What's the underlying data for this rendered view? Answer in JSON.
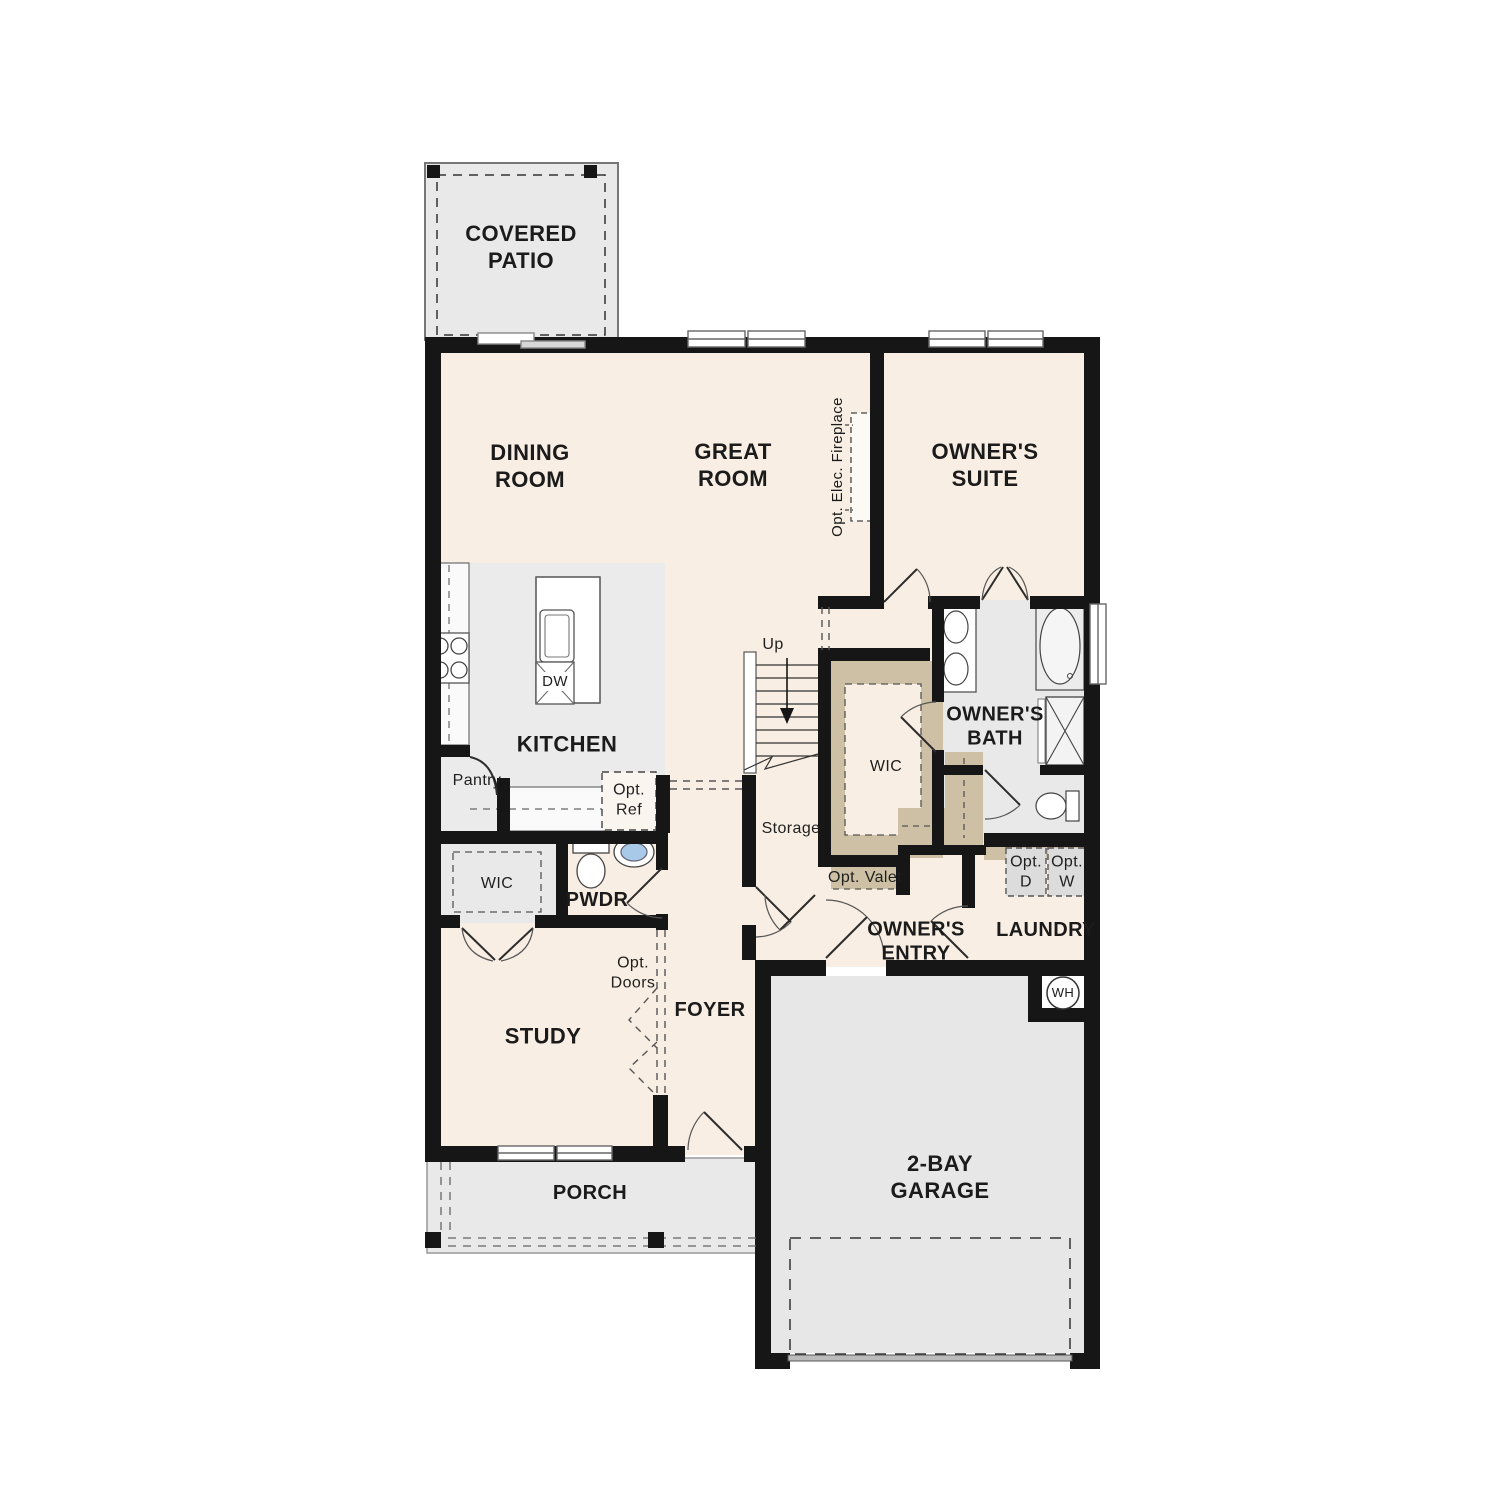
{
  "plan": {
    "rooms": {
      "covered_patio": "COVERED\nPATIO",
      "dining_room": "DINING\nROOM",
      "great_room": "GREAT\nROOM",
      "owners_suite": "OWNER'S\nSUITE",
      "kitchen": "KITCHEN",
      "study": "STUDY",
      "foyer": "FOYER",
      "porch": "PORCH",
      "garage": "2-BAY\nGARAGE",
      "owners_bath": "OWNER'S\nBATH",
      "laundry": "LAUNDRY",
      "owners_entry": "OWNER'S\nENTRY",
      "pwdr": "PWDR",
      "wic_primary": "WIC",
      "wic_secondary": "WIC",
      "storage": "Storage",
      "pantry": "Pantry"
    },
    "annotations": {
      "up": "Up",
      "dw": "DW",
      "opt_ref": "Opt.\nRef",
      "opt_valet": "Opt. Valet",
      "opt_d": "Opt.\nD",
      "opt_w": "Opt.\nW",
      "opt_doors": "Opt.\nDoors",
      "opt_elec_fireplace": "Opt. Elec. Fireplace",
      "wh": "WH"
    },
    "colors": {
      "wall": "#161616",
      "room_fill": "#f8eee3",
      "zone_fill": "#ebebeb",
      "gray_fill": "#e9e9e9",
      "closet_fill": "#cdc0a4",
      "sink_fill": "#a9c9e9"
    }
  }
}
